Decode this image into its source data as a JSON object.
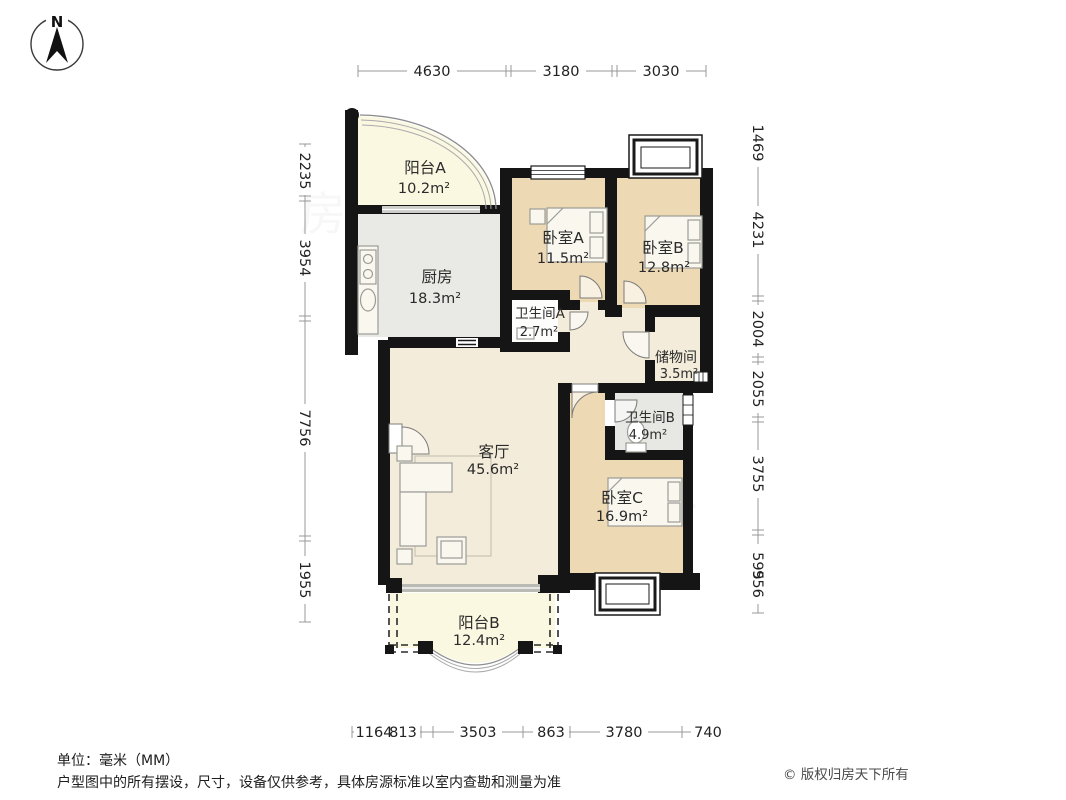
{
  "compass": {
    "north_label": "N"
  },
  "rooms": [
    {
      "id": "balcony-a",
      "name": "阳台A",
      "area": "10.2m²"
    },
    {
      "id": "kitchen",
      "name": "厨房",
      "area": "18.3m²"
    },
    {
      "id": "bedroom-a",
      "name": "卧室A",
      "area": "11.5m²"
    },
    {
      "id": "bedroom-b",
      "name": "卧室B",
      "area": "12.8m²"
    },
    {
      "id": "bath-a",
      "name": "卫生间A",
      "area": "2.7m²"
    },
    {
      "id": "storage",
      "name": "储物间",
      "area": "3.5m²"
    },
    {
      "id": "bath-b",
      "name": "卫生间B",
      "area": "4.9m²"
    },
    {
      "id": "living",
      "name": "客厅",
      "area": "45.6m²"
    },
    {
      "id": "bedroom-c",
      "name": "卧室C",
      "area": "16.9m²"
    },
    {
      "id": "balcony-b",
      "name": "阳台B",
      "area": "12.4m²"
    }
  ],
  "dims": {
    "top": [
      "4630",
      "3180",
      "3030"
    ],
    "left": [
      "2235",
      "3954",
      "7756",
      "1955"
    ],
    "right": [
      "1469",
      "4231",
      "2004",
      "2055",
      "3755",
      "595",
      "956"
    ],
    "bottom": [
      "1164",
      "813",
      "3503",
      "863",
      "3780",
      "740"
    ]
  },
  "footer": {
    "unit": "单位：毫米（MM）",
    "disclaimer": "户型图中的所有摆设，尺寸，设备仅供参考，具体房源标准以室内查勘和测量为准",
    "copyright": "© 版权归房天下所有"
  },
  "watermark": "房天下",
  "colors": {
    "wall": "#151515",
    "bedroom_fill": "#EDD9B3",
    "balcony_fill": "#FBF8E2",
    "gray_room_fill": "#E9E9E6",
    "living_fill": "#F3ECDA",
    "dim_line": "#999999"
  }
}
